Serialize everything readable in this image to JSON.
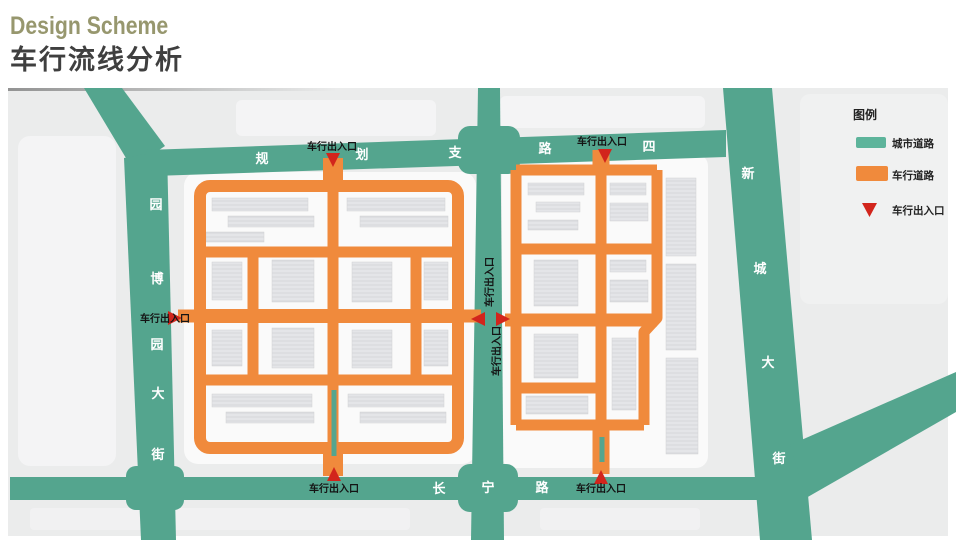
{
  "header": {
    "title": "Design Scheme",
    "subtitle": "车行流线分析"
  },
  "legend": {
    "title": "图例",
    "items": [
      {
        "label": "城市道路",
        "color": "#5db49b",
        "symbol": "green-road-swatch"
      },
      {
        "label": "车行道路",
        "color": "#f08a3c",
        "symbol": "orange-road-swatch"
      },
      {
        "label": "车行出入口",
        "color": "#d2251c",
        "symbol": "red-triangle"
      }
    ]
  },
  "map": {
    "entrance_label": "车行出入口",
    "roads": {
      "planning_branch_road_4": {
        "name": "规划支路四",
        "chars": [
          "规",
          "划",
          "支",
          "路",
          "四"
        ]
      },
      "yuanboyuan_avenue": {
        "name": "园博园大街",
        "chars": [
          "园",
          "博",
          "园",
          "大",
          "街"
        ]
      },
      "xincheng_avenue": {
        "name": "新城大街",
        "chars": [
          "新",
          "城",
          "大",
          "街"
        ]
      },
      "changning_road": {
        "name": "长宁路",
        "chars": [
          "长",
          "宁",
          "路"
        ]
      }
    },
    "colors": {
      "city_road": "#54a58e",
      "vehicle_road": "#f08a3c",
      "entrance_marker": "#d2251c"
    }
  }
}
